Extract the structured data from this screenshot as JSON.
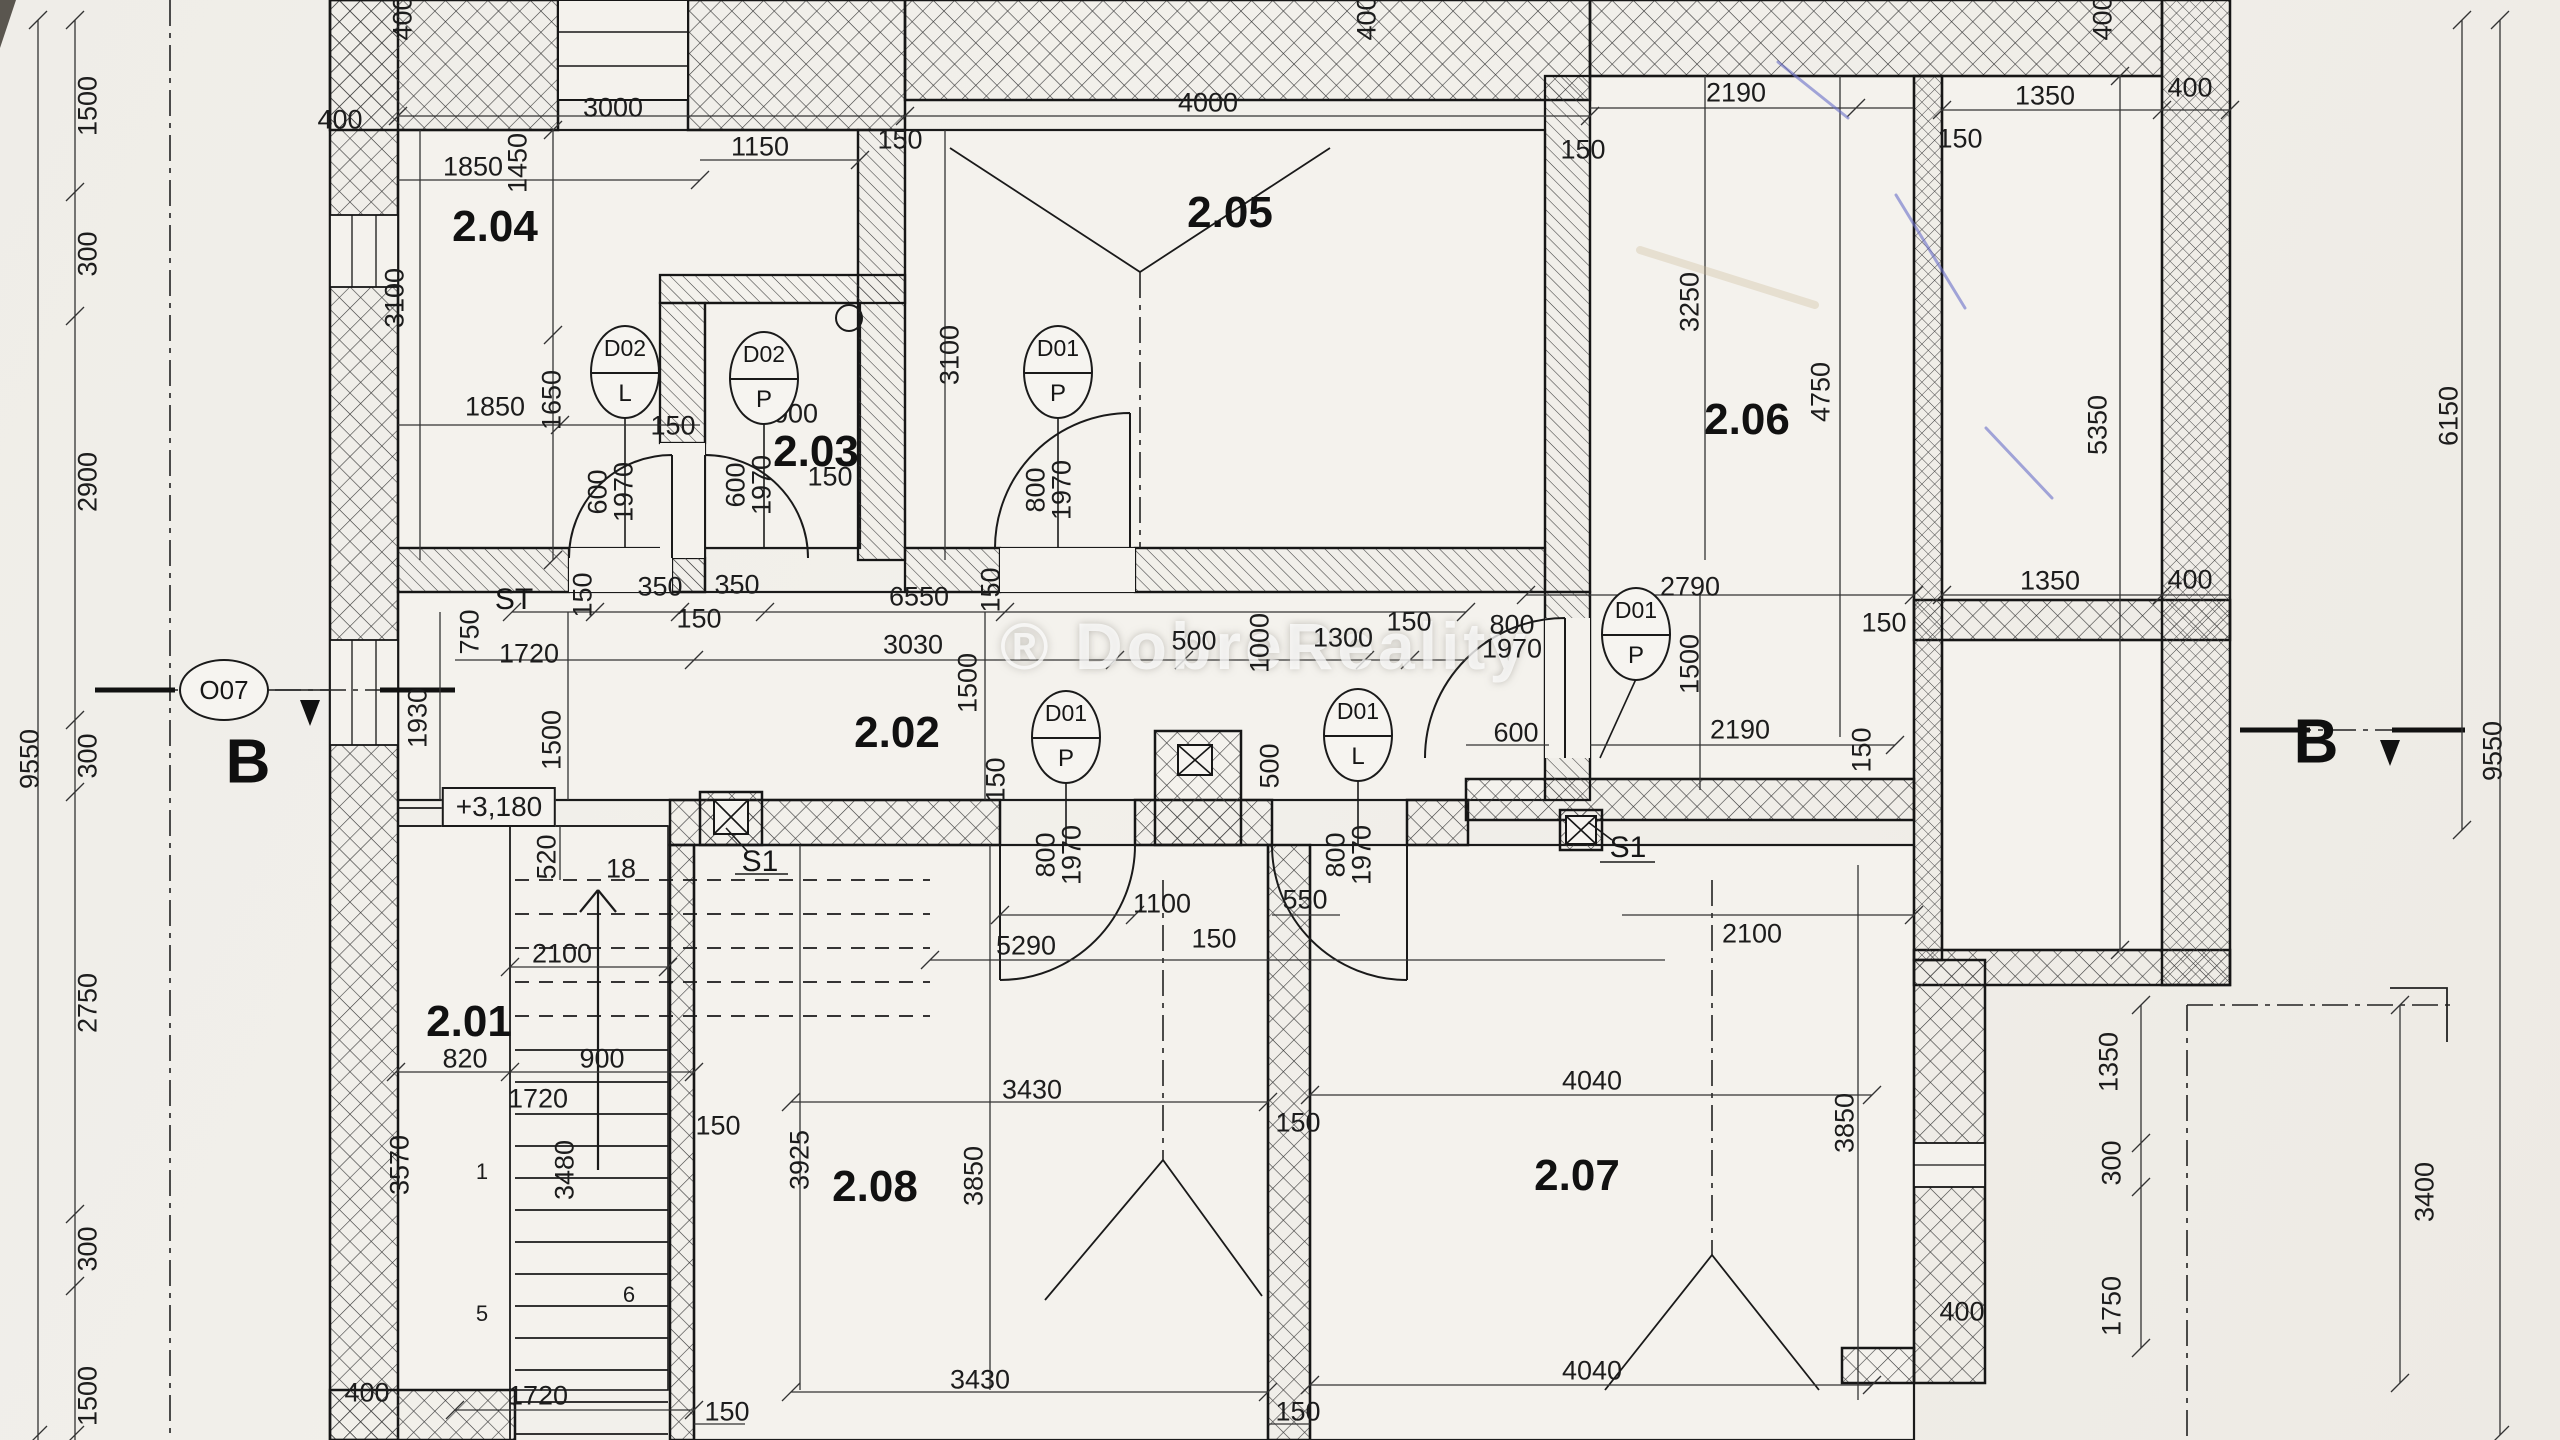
{
  "drawing": {
    "type": "architectural floor plan",
    "watermark": "® DobreReality",
    "level_mark": "+3,180",
    "stair_riser_note": "18"
  },
  "rooms": [
    {
      "label": "2.04",
      "x": 495,
      "y": 227
    },
    {
      "label": "2.05",
      "x": 1230,
      "y": 213
    },
    {
      "label": "2.03",
      "x": 816,
      "y": 452
    },
    {
      "label": "2.06",
      "x": 1747,
      "y": 420
    },
    {
      "label": "2.02",
      "x": 897,
      "y": 733
    },
    {
      "label": "2.01",
      "x": 469,
      "y": 1022
    },
    {
      "label": "2.08",
      "x": 875,
      "y": 1187
    },
    {
      "label": "2.07",
      "x": 1577,
      "y": 1176
    }
  ],
  "door_tags": [
    {
      "code": "D02",
      "leaf": "L",
      "x": 625,
      "y": 372
    },
    {
      "code": "D02",
      "leaf": "P",
      "x": 764,
      "y": 378
    },
    {
      "code": "D01",
      "leaf": "P",
      "x": 1058,
      "y": 372
    },
    {
      "code": "D01",
      "leaf": "P",
      "x": 1066,
      "y": 737
    },
    {
      "code": "D01",
      "leaf": "L",
      "x": 1358,
      "y": 735
    },
    {
      "code": "D01",
      "leaf": "P",
      "x": 1636,
      "y": 634
    }
  ],
  "window_tags": [
    {
      "code": "O07",
      "x": 224,
      "y": 690
    }
  ],
  "section_letters": [
    {
      "t": "B",
      "x": 248,
      "y": 762
    },
    {
      "t": "B",
      "x": 2316,
      "y": 742
    }
  ],
  "chimney_tags": [
    {
      "t": "S1",
      "x": 760,
      "y": 862
    },
    {
      "t": "S1",
      "x": 1628,
      "y": 848
    }
  ],
  "stair_tag": {
    "t": "ST",
    "x": 514,
    "y": 600
  },
  "level_tag": {
    "x": 499,
    "y": 807
  },
  "stair_numbers": [
    {
      "t": "1",
      "x": 482,
      "y": 1172
    },
    {
      "t": "5",
      "x": 482,
      "y": 1314
    },
    {
      "t": "6",
      "x": 629,
      "y": 1295
    }
  ],
  "dims": [
    [
      "400",
      403,
      18,
      1
    ],
    [
      "400",
      340,
      120,
      0
    ],
    [
      "3000",
      613,
      108,
      0
    ],
    [
      "1850",
      473,
      167,
      0
    ],
    [
      "1450",
      518,
      163,
      1
    ],
    [
      "1150",
      760,
      147,
      0
    ],
    [
      "150",
      900,
      140,
      0
    ],
    [
      "3100",
      395,
      298,
      1
    ],
    [
      "1850",
      495,
      407,
      0
    ],
    [
      "1650",
      552,
      400,
      1
    ],
    [
      "150",
      673,
      426,
      0
    ],
    [
      "600",
      598,
      492,
      1
    ],
    [
      "1970",
      624,
      492,
      1
    ],
    [
      "1000",
      788,
      414,
      0
    ],
    [
      "150",
      830,
      477,
      0
    ],
    [
      "600",
      736,
      485,
      1
    ],
    [
      "1970",
      762,
      485,
      1
    ],
    [
      "4000",
      1208,
      103,
      0
    ],
    [
      "150",
      1583,
      150,
      0
    ],
    [
      "3100",
      950,
      355,
      1
    ],
    [
      "400",
      1367,
      18,
      1
    ],
    [
      "800",
      1036,
      490,
      1
    ],
    [
      "1970",
      1062,
      490,
      1
    ],
    [
      "2190",
      1736,
      93,
      0
    ],
    [
      "3250",
      1690,
      302,
      1
    ],
    [
      "4750",
      1821,
      392,
      1
    ],
    [
      "400",
      2103,
      18,
      1
    ],
    [
      "1350",
      2045,
      96,
      0
    ],
    [
      "150",
      1960,
      139,
      0
    ],
    [
      "400",
      2190,
      88,
      0
    ],
    [
      "5350",
      2098,
      425,
      1
    ],
    [
      "6150",
      2449,
      416,
      1
    ],
    [
      "9550",
      2493,
      751,
      1
    ],
    [
      "1500",
      88,
      106,
      1
    ],
    [
      "300",
      88,
      254,
      1
    ],
    [
      "2900",
      88,
      482,
      1
    ],
    [
      "9550",
      30,
      759,
      1
    ],
    [
      "300",
      88,
      756,
      1
    ],
    [
      "2750",
      88,
      1003,
      1
    ],
    [
      "300",
      88,
      1249,
      1
    ],
    [
      "1500",
      88,
      1396,
      1
    ],
    [
      "150",
      583,
      595,
      1
    ],
    [
      "350",
      660,
      587,
      0
    ],
    [
      "350",
      737,
      585,
      0
    ],
    [
      "6550",
      919,
      597,
      0
    ],
    [
      "150",
      991,
      590,
      1
    ],
    [
      "150",
      699,
      619,
      0
    ],
    [
      "750",
      470,
      632,
      1
    ],
    [
      "1720",
      529,
      654,
      0
    ],
    [
      "3030",
      913,
      645,
      0
    ],
    [
      "1500",
      968,
      683,
      1
    ],
    [
      "500",
      1194,
      641,
      0
    ],
    [
      "1000",
      1260,
      643,
      1
    ],
    [
      "1300",
      1343,
      638,
      0
    ],
    [
      "150",
      1409,
      622,
      0
    ],
    [
      "1930",
      418,
      718,
      1
    ],
    [
      "1500",
      552,
      740,
      1
    ],
    [
      "500",
      1270,
      766,
      1
    ],
    [
      "150",
      996,
      780,
      1
    ],
    [
      "800",
      1046,
      855,
      1
    ],
    [
      "1970",
      1072,
      855,
      1
    ],
    [
      "800",
      1336,
      855,
      1
    ],
    [
      "1970",
      1362,
      855,
      1
    ],
    [
      "600",
      1516,
      733,
      0
    ],
    [
      "2190",
      1740,
      730,
      0
    ],
    [
      "150",
      1862,
      750,
      1
    ],
    [
      "2790",
      1690,
      587,
      0
    ],
    [
      "150",
      1884,
      623,
      0
    ],
    [
      "800",
      1512,
      625,
      0
    ],
    [
      "1970",
      1512,
      649,
      0
    ],
    [
      "1500",
      1690,
      664,
      1
    ],
    [
      "1350",
      2050,
      581,
      0
    ],
    [
      "400",
      2190,
      580,
      0
    ],
    [
      "520",
      547,
      857,
      1
    ],
    [
      "18",
      621,
      869,
      0
    ],
    [
      "2100",
      562,
      954,
      0
    ],
    [
      "820",
      465,
      1059,
      0
    ],
    [
      "900",
      602,
      1059,
      0
    ],
    [
      "1720",
      538,
      1099,
      0
    ],
    [
      "3570",
      400,
      1165,
      1
    ],
    [
      "3480",
      565,
      1170,
      1
    ],
    [
      "150",
      718,
      1126,
      0
    ],
    [
      "1100",
      1162,
      904,
      0
    ],
    [
      "550",
      1305,
      900,
      0
    ],
    [
      "5290",
      1026,
      946,
      0
    ],
    [
      "150",
      1214,
      939,
      0
    ],
    [
      "2100",
      1752,
      934,
      0
    ],
    [
      "3925",
      800,
      1160,
      1
    ],
    [
      "3850",
      974,
      1176,
      1
    ],
    [
      "3430",
      1032,
      1090,
      0
    ],
    [
      "4040",
      1592,
      1081,
      0
    ],
    [
      "150",
      1298,
      1123,
      0
    ],
    [
      "3850",
      1845,
      1123,
      1
    ],
    [
      "3430",
      980,
      1380,
      0
    ],
    [
      "150",
      727,
      1412,
      0
    ],
    [
      "150",
      1298,
      1412,
      0
    ],
    [
      "4040",
      1592,
      1371,
      0
    ],
    [
      "400",
      1962,
      1312,
      0
    ],
    [
      "1720",
      538,
      1396,
      0
    ],
    [
      "400",
      367,
      1393,
      0
    ],
    [
      "1350",
      2109,
      1062,
      1
    ],
    [
      "300",
      2112,
      1163,
      1
    ],
    [
      "1750",
      2112,
      1306,
      1
    ],
    [
      "3400",
      2425,
      1192,
      1
    ]
  ],
  "colors": {
    "paper": "#f0eee9",
    "ink": "#1a1a1a",
    "pen_mark_blue": "#6a6fc9",
    "stain_tan": "#c9b48f"
  }
}
